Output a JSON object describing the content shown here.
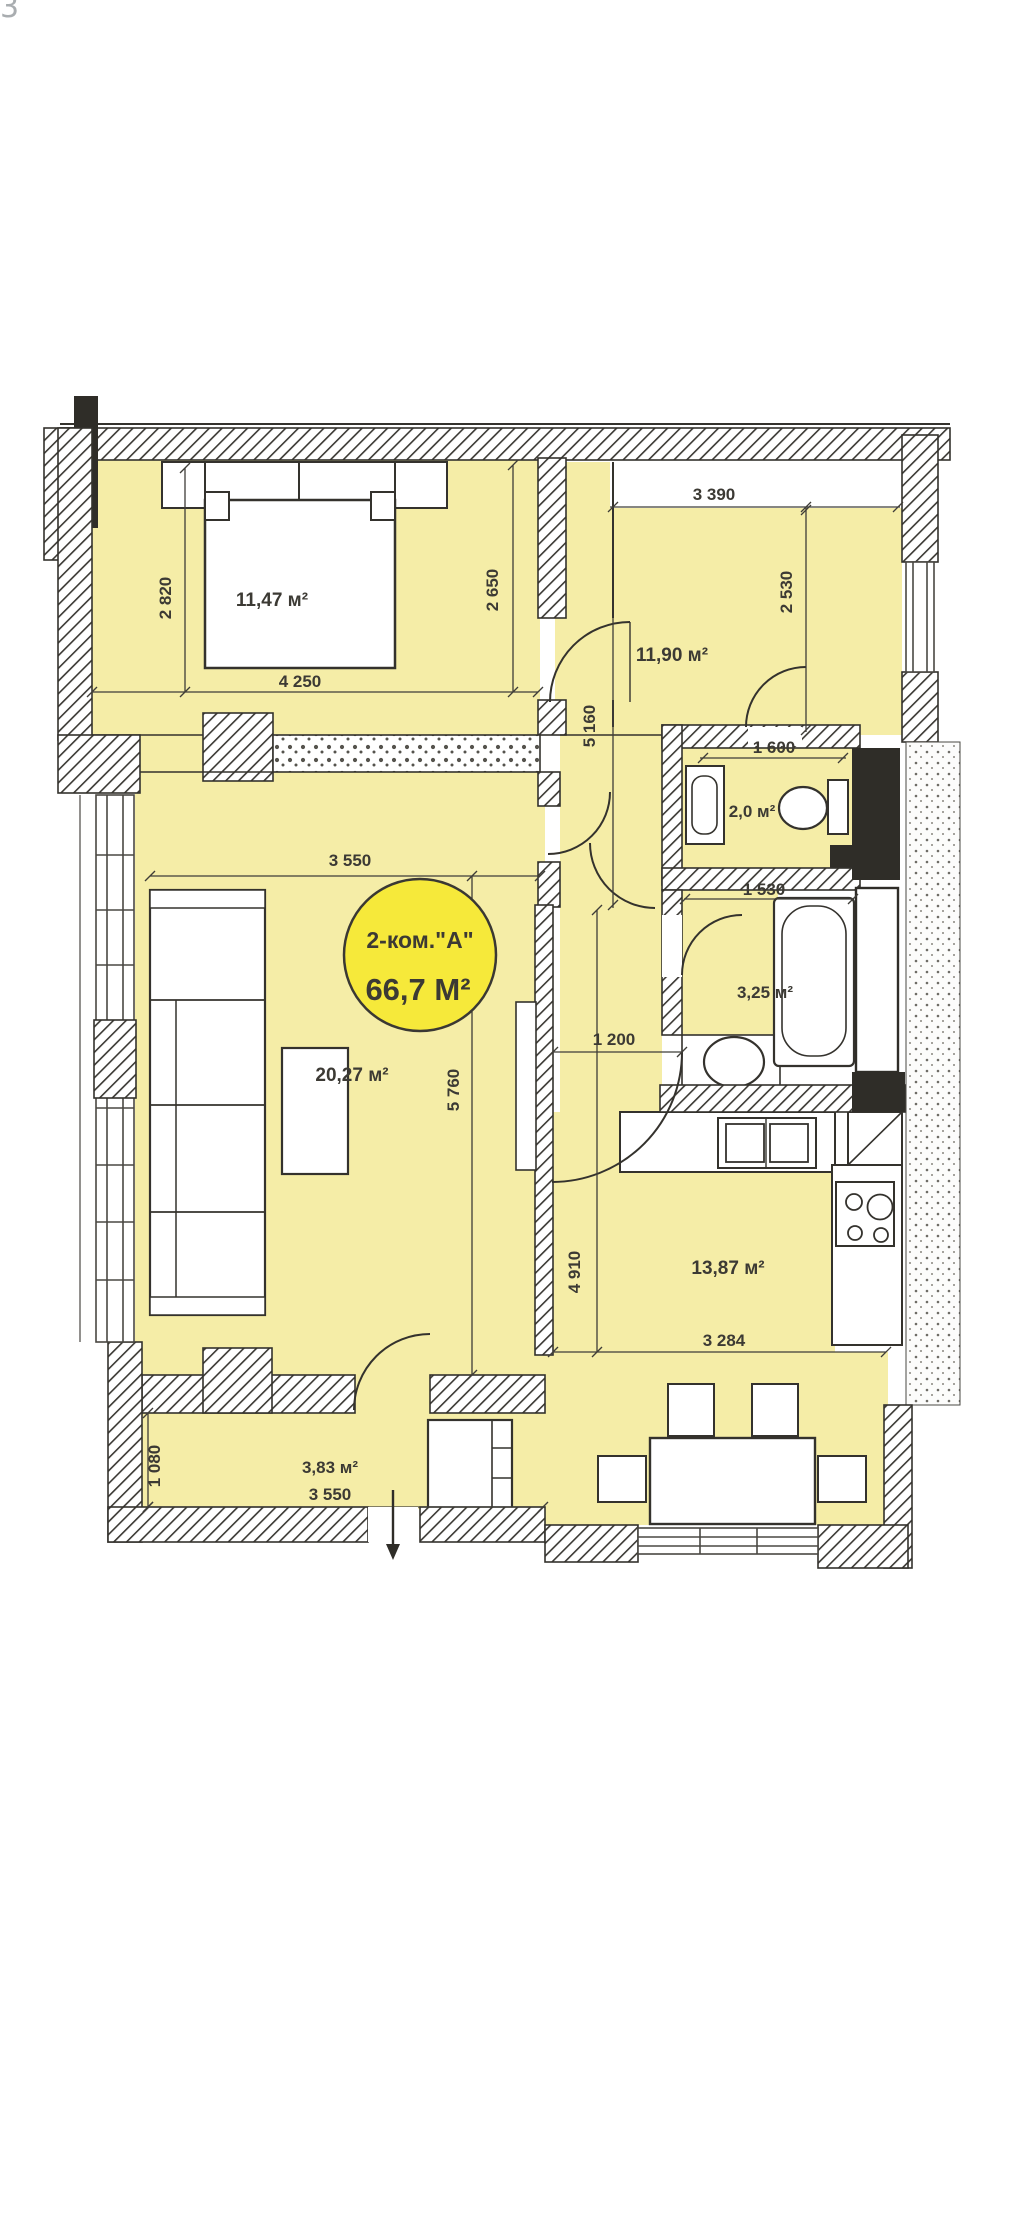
{
  "page": {
    "corner_mark": "3"
  },
  "plan": {
    "badge": {
      "line1": "2-ком.\"А\"",
      "line2": "66,7 М²"
    },
    "rooms": {
      "bedroom": "11,47 м²",
      "room2": "11,90 м²",
      "wc": "2,0 м²",
      "bath": "3,25 м²",
      "living": "20,27 м²",
      "kitchen": "13,87 м²",
      "hall": "3,83 м²"
    },
    "dims": {
      "d3390": "3 390",
      "d2820": "2 820",
      "d2650": "2 650",
      "d2530": "2 530",
      "d4250": "4 250",
      "d5160": "5 160",
      "d1600": "1 600",
      "d1530": "1 530",
      "d3550_top": "3 550",
      "d5760": "5 760",
      "d1200": "1 200",
      "d4910": "4 910",
      "d3284": "3 284",
      "d3550_bottom": "3 550",
      "d1080": "1 080"
    },
    "colors": {
      "room_fill": "#f5eda7",
      "badge_fill": "#f6e93a",
      "wall": "#34322d",
      "dim_text": "#3c3a34"
    }
  }
}
